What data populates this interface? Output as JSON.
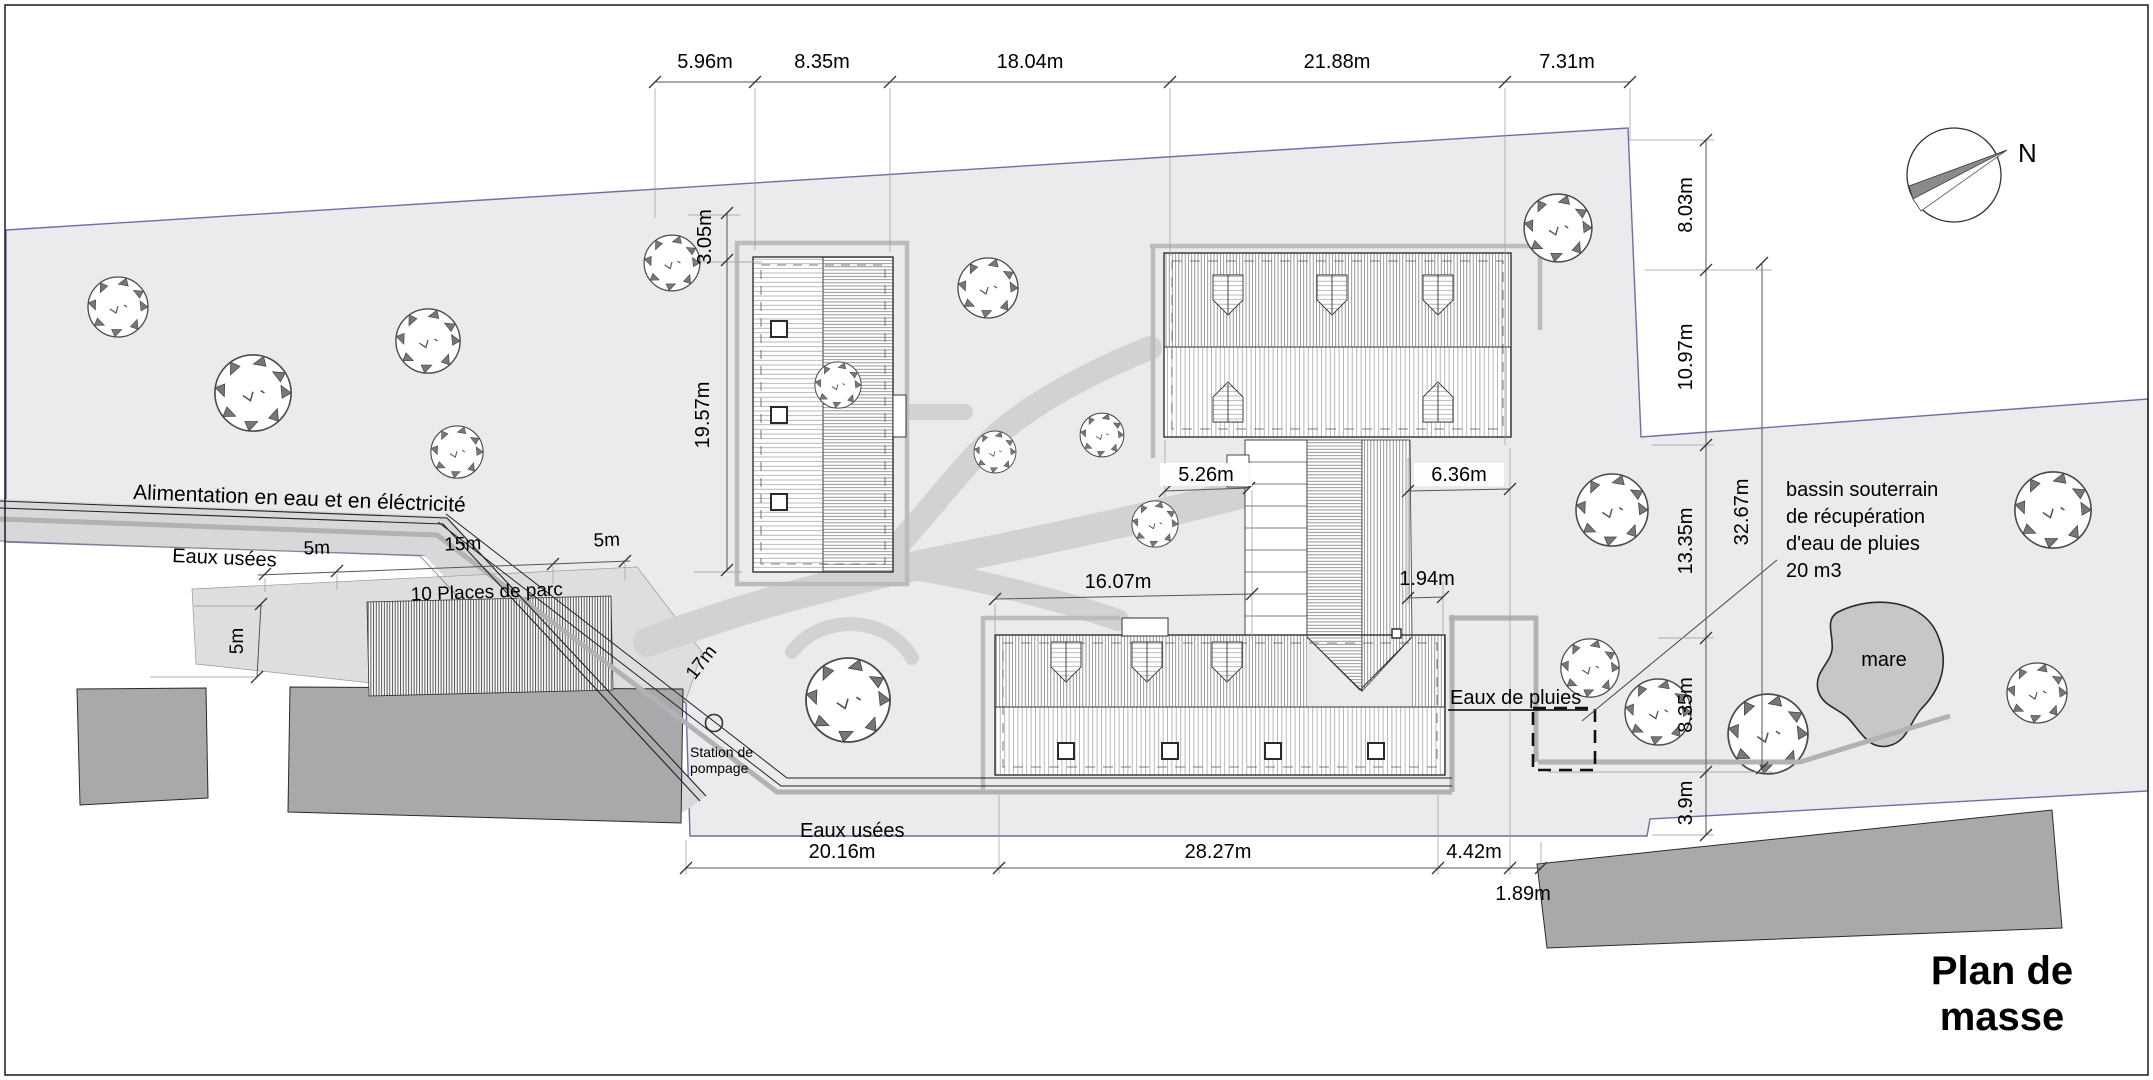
{
  "page": {
    "title_line1": "Plan de",
    "title_line2": "masse"
  },
  "compass": {
    "north_label": "N"
  },
  "site_labels": {
    "water_power": "Alimentation en eau et en éléctricité",
    "waste_water_top": "Eaux usées",
    "waste_water_bottom": "Eaux usées",
    "rain_water": "Eaux de pluies",
    "parking": "10 Places de parc",
    "pump_station_line1": "Station de",
    "pump_station_line2": "pompage",
    "basin_line1": "bassin souterrain",
    "basin_line2": "de récupération",
    "basin_line3": "d'eau de pluies",
    "basin_line4": "20 m3",
    "pond": "mare"
  },
  "dimensions": {
    "top": [
      "5.96m",
      "8.35m",
      "18.04m",
      "21.88m",
      "7.31m"
    ],
    "right": [
      "8.03m",
      "10.97m",
      "13.35m",
      "8.35m",
      "3.9m"
    ],
    "right_overall": "32.67m",
    "left": [
      "3.05m",
      "19.57m"
    ],
    "bottom": [
      "20.16m",
      "28.27m",
      "4.42m"
    ],
    "bottom_offset": "1.89m",
    "middle": [
      "5.26m",
      "6.36m",
      "16.07m",
      "1.94m"
    ],
    "road": [
      "5m",
      "15m",
      "5m"
    ],
    "parking_depth": "5m",
    "sewer_run": "17m"
  },
  "colors": {
    "parcel": "#ebebed",
    "road": "#d8d8da",
    "neighbor_building": "#a9a9ab",
    "pond": "#c7c7c9",
    "boundary": "#6b6fa8",
    "path": "#d2d2d4"
  }
}
